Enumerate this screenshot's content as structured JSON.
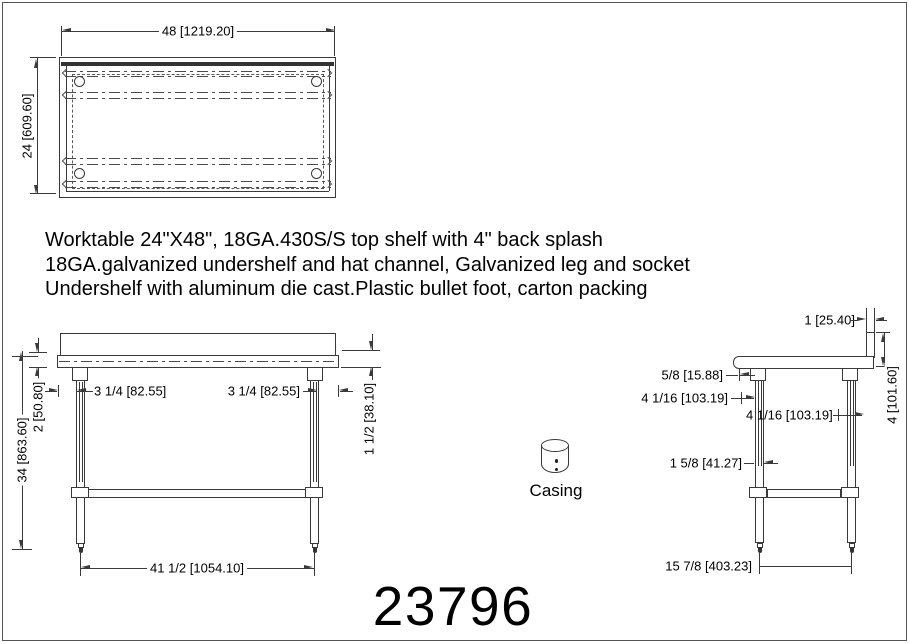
{
  "drawing": {
    "part_number": "23796",
    "casing_label": "Casing",
    "description_lines": [
      "Worktable 24\"X48\", 18GA.430S/S top shelf with 4\" back splash",
      "18GA.galvanized undershelf and hat channel, Galvanized leg and socket",
      "Undershelf with aluminum die cast.Plastic bullet foot, carton packing"
    ],
    "colors": {
      "line": "#3a3a3a",
      "text": "#000000",
      "background": "#ffffff"
    },
    "top_view": {
      "width_dim": "48 [1219.20]",
      "depth_dim": "24 [609.60]"
    },
    "front_view": {
      "edge_height_dim": "2 [50.80]",
      "overall_height_dim": "34 [863.60]",
      "leg_inset_left_dim": "3 1/4 [82.55]",
      "leg_inset_right_dim": "3 1/4 [82.55]",
      "edge_dim_right": "1 1/2 [38.10]",
      "leg_span_dim": "41 1/2 [1054.10]"
    },
    "side_view": {
      "splash_thickness_dim": "1 [25.40]",
      "splash_height_dim": "4 [101.60]",
      "socket_offset_dim": "5/8 [15.88]",
      "leg_offset_dim_1": "4 1/16 [103.19]",
      "leg_offset_dim_2": "4 1/16 [103.19]",
      "leg_diameter_dim": "1 5/8 [41.27]",
      "leg_span_dim": "15 7/8 [403.23]"
    }
  }
}
